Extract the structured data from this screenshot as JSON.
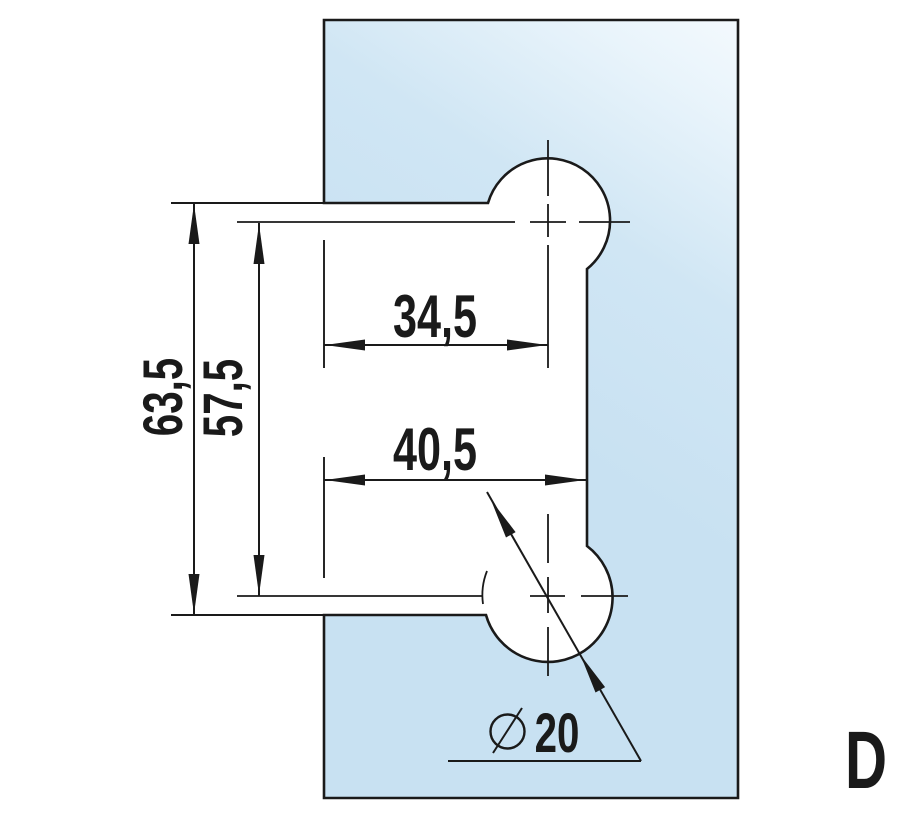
{
  "drawing": {
    "labels": {
      "overall_height": "63,5",
      "hole_spacing": "57,5",
      "top_hole_offset": "34,5",
      "bottom_hole_offset": "40,5",
      "hole_diameter_value": "20",
      "variant": "D"
    },
    "colors": {
      "line": "#1a1a1a",
      "background": "#ffffff",
      "glass_highlight": "#f7fbfe",
      "glass_light": "#e9f4fb",
      "glass_mid": "#d0e6f4",
      "glass_deep": "#c8e1f2"
    }
  }
}
